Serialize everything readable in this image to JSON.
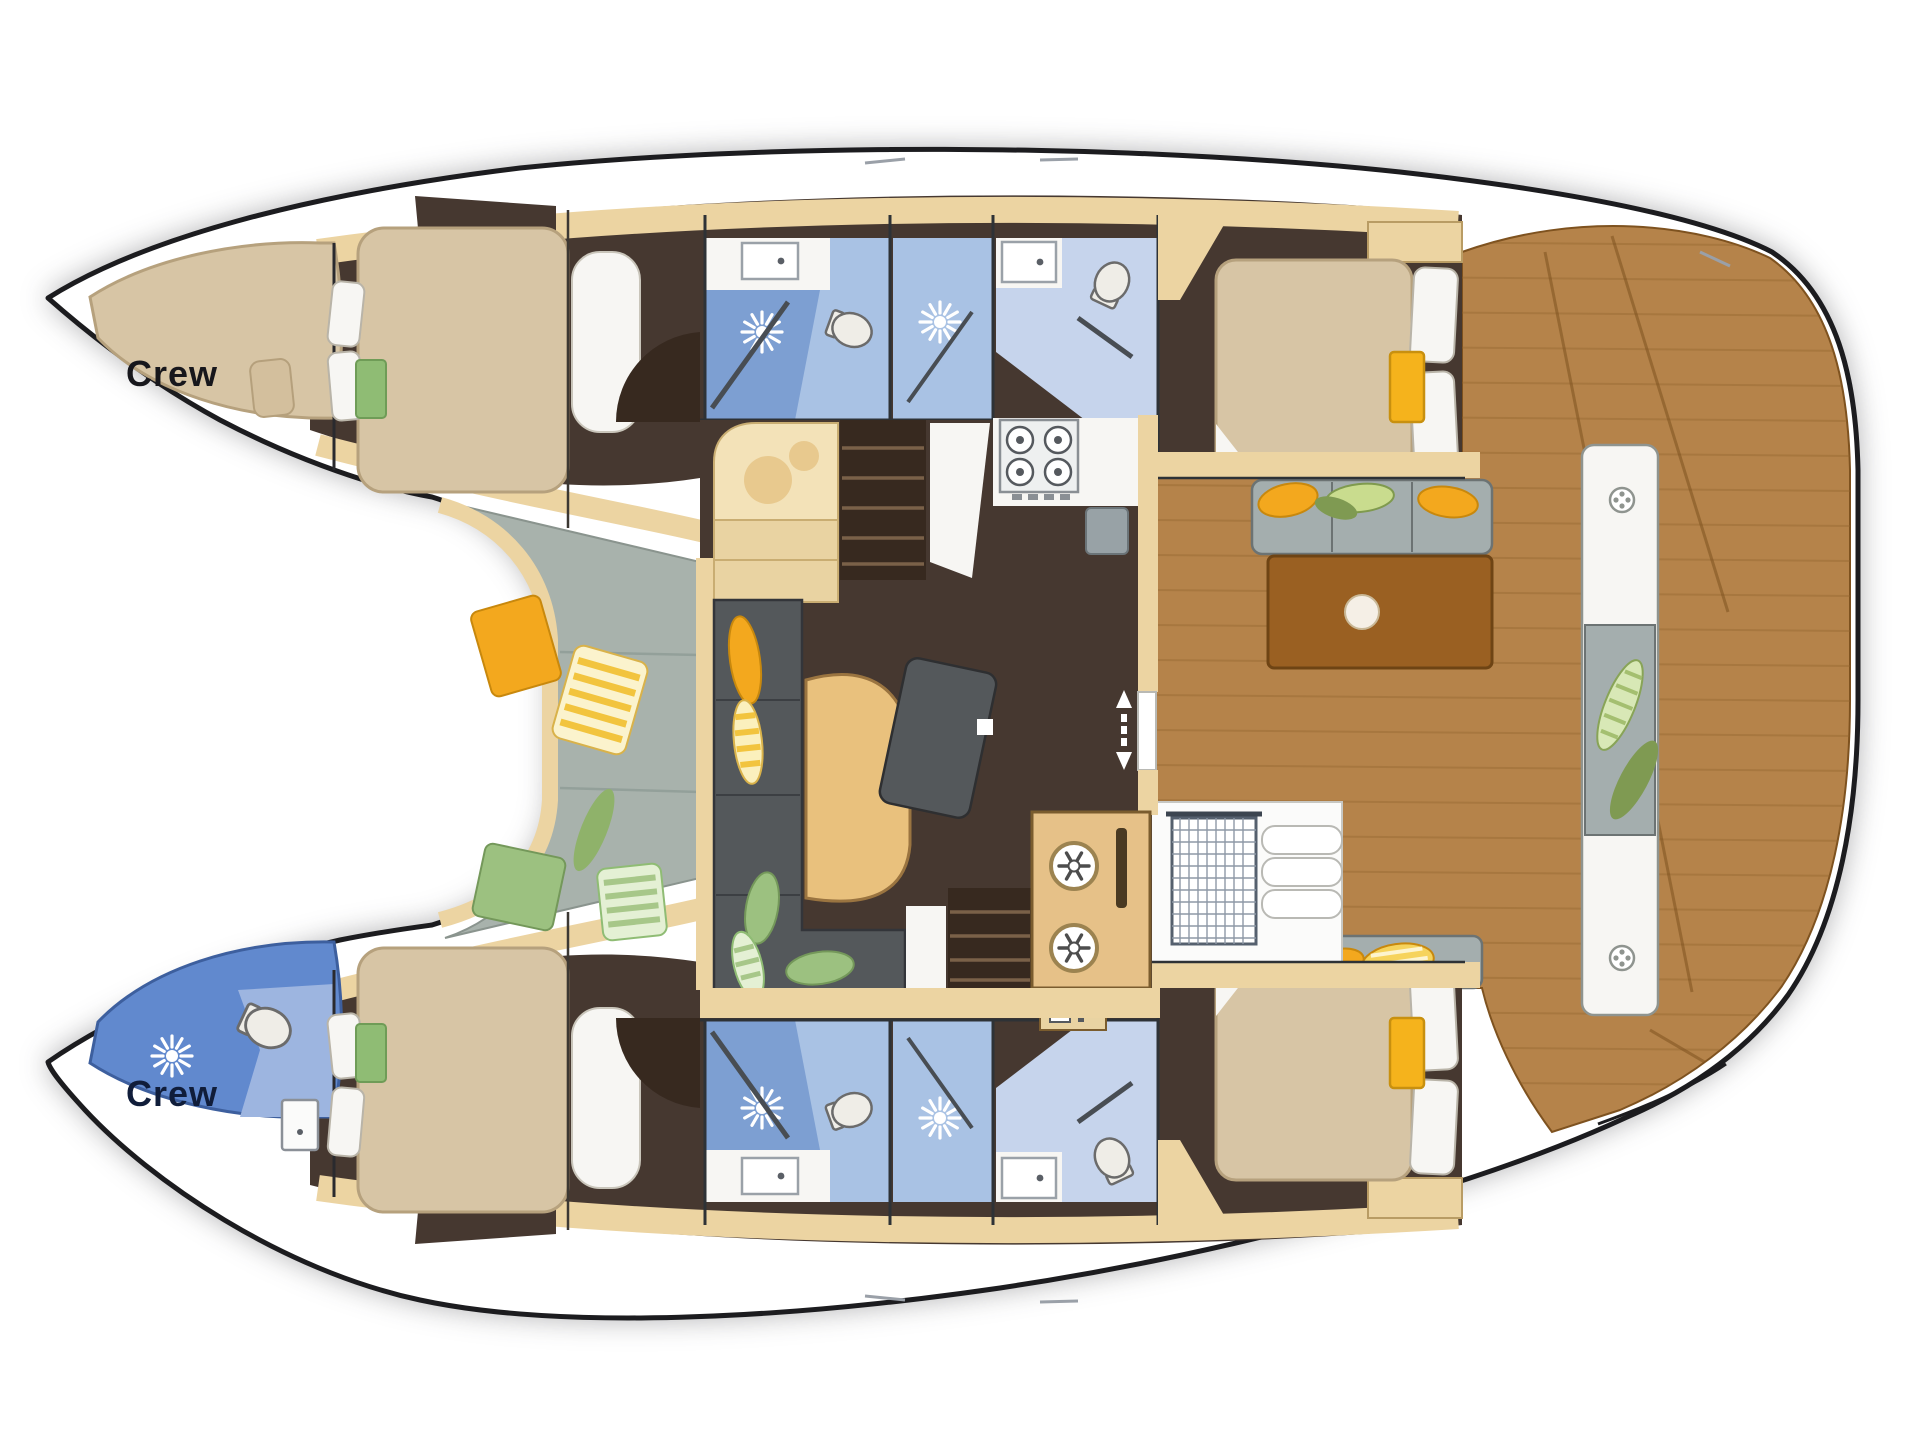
{
  "labels": {
    "crew_port": "Crew",
    "crew_starboard": "Crew"
  },
  "icons": {
    "shower": "sunburst-shower-icon",
    "toilet": "toilet-icon",
    "sink": "sink-basin-icon",
    "stove": "four-burner-stove-icon",
    "fridge": "snowflake-fridge-icon",
    "sliding_door": "double-arrow-slider-icon",
    "deck_cleat": "cleat-icon",
    "nav_grate": "grid-hatch-icon"
  },
  "colors": {
    "outline": "#1c1c1f",
    "deck": "#ffffff",
    "cabin_tan": "#d7c5a5",
    "cabin_tan_edge": "#b6a17d",
    "trim": "#ecd4a2",
    "floor": "#463830",
    "floor_dark": "#37291f",
    "bath_blue": "#7d9fd2",
    "bath_blue_mid": "#a9c2e4",
    "bath_blue_pale": "#c6d4ec",
    "crew_blue": "#6189ce",
    "lounge_gray": "#a8b2ac",
    "sofa": "#54585b",
    "table_tan": "#e9c17d",
    "wood": "#b5834a",
    "wood_grain": "#91642e",
    "cockpit_table": "#9a6022",
    "bench": "#a4aeae",
    "yellow": "#f3a81e",
    "green": "#9cc180",
    "white_fix": "#f7f6f3",
    "fridge_tan": "#e6c188"
  }
}
